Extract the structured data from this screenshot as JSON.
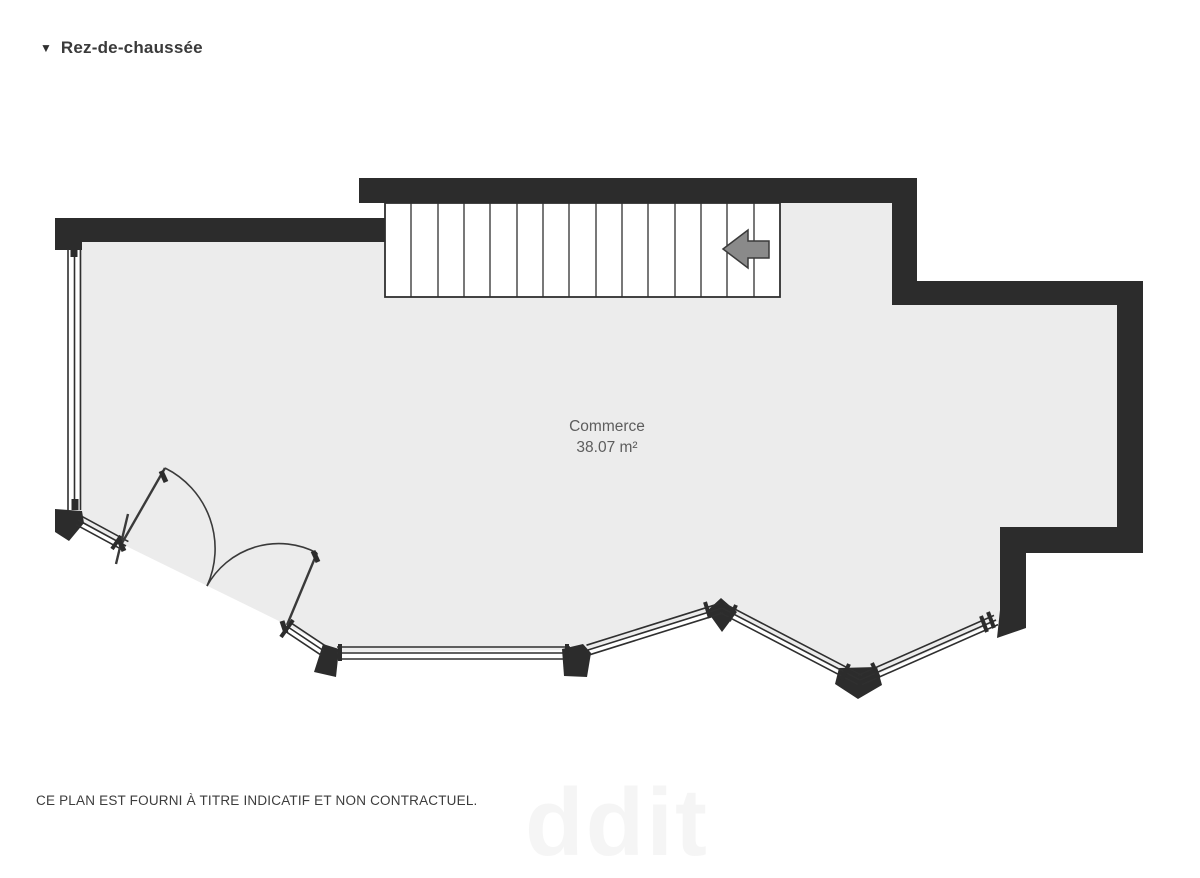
{
  "header": {
    "collapse_icon": "▼",
    "title": "Rez-de-chaussée"
  },
  "room": {
    "name": "Commerce",
    "area": "38.07 m²"
  },
  "stairs": {
    "treads": 15,
    "direction_icon": "left-arrow"
  },
  "footer": {
    "disclaimer": "CE PLAN EST FOURNI À TITRE INDICATIF ET NON CONTRACTUEL."
  },
  "watermark": {
    "text": "ddit"
  },
  "colors": {
    "wall": "#2c2c2c",
    "floor": "#ececec",
    "line": "#2f2f2f",
    "arrow_fill": "#8a8a8a",
    "title_text": "#3a3a3a",
    "label_text": "#5d5d5d",
    "disclaimer_text": "#3c3c3c"
  }
}
